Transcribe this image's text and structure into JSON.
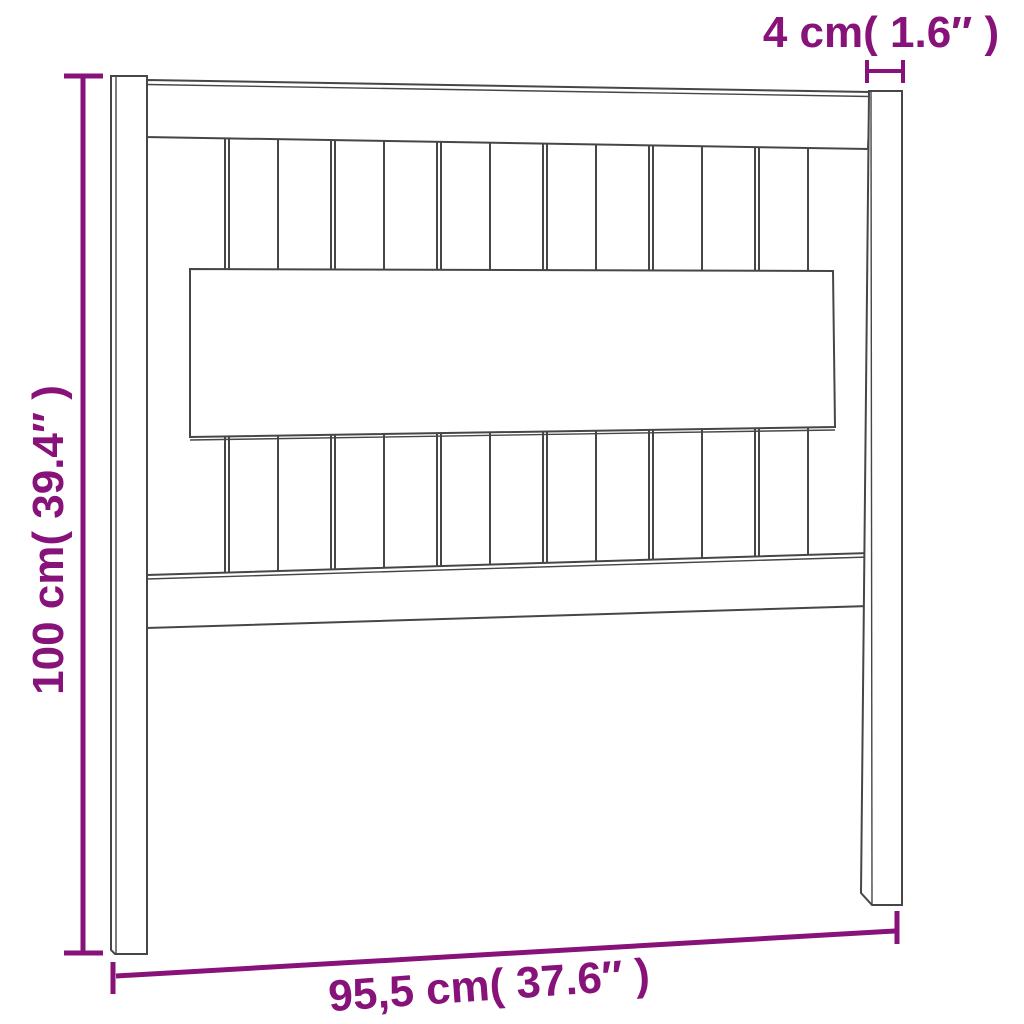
{
  "diagram": {
    "labels": {
      "height": "100 cm( 39.4″ )",
      "width": "95,5 cm( 37.6″ )",
      "post_width": "4 cm( 1.6″ )"
    }
  },
  "colors": {
    "accent": "#871279",
    "line": "#464646",
    "background": "#ffffff"
  }
}
